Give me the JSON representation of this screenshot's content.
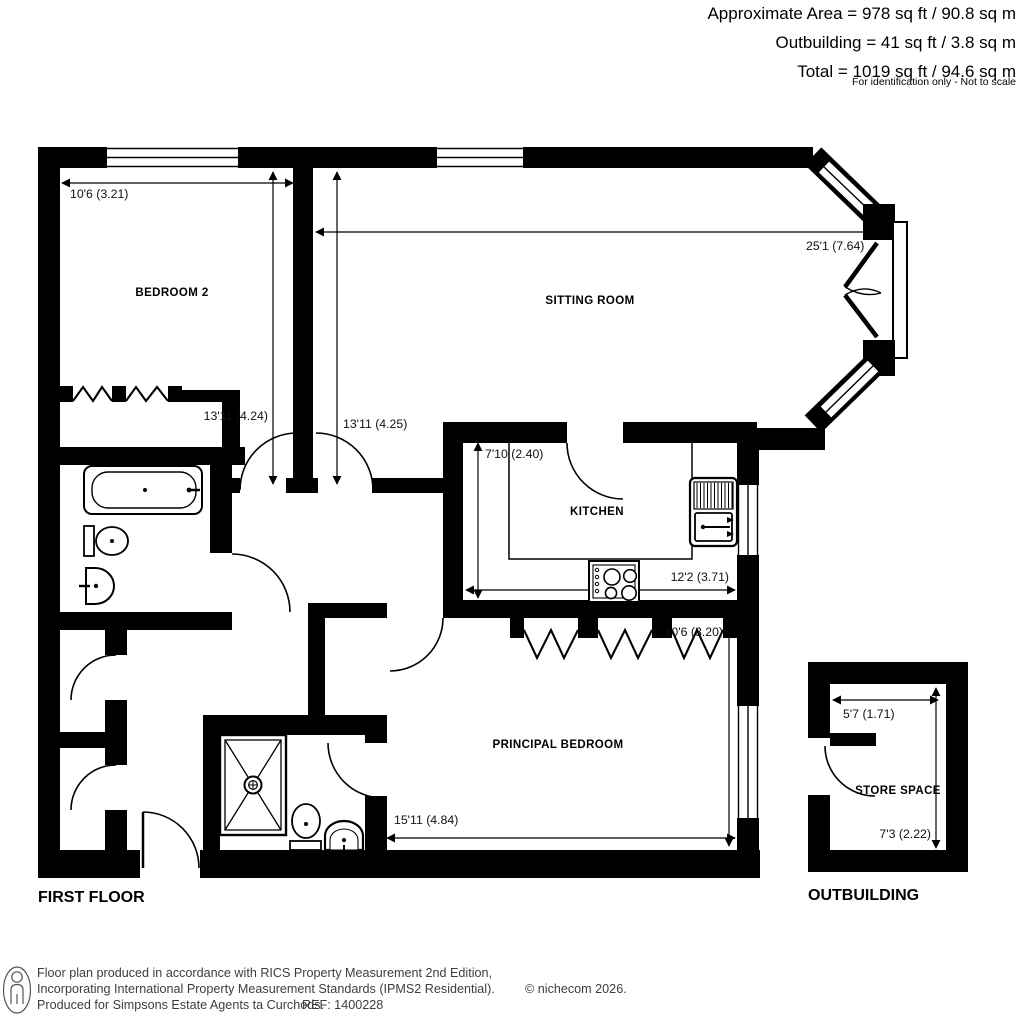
{
  "header": {
    "approximate_area": "Approximate Area = 978 sq ft / 90.8 sq m",
    "outbuilding_area": "Outbuilding = 41 sq ft / 3.8 sq m",
    "total_area": "Total = 1019 sq ft / 94.6 sq m",
    "note": "For identification only - Not to scale"
  },
  "plan": {
    "first_floor_label": "FIRST FLOOR",
    "outbuilding_label": "OUTBUILDING"
  },
  "rooms": [
    {
      "name": "BEDROOM 2",
      "width_label": "10'6 (3.21)",
      "depth_label": "13'11 (4.24)"
    },
    {
      "name": "SITTING ROOM",
      "width_label": "25'1 (7.64)",
      "depth_label": "13'11 (4.25)"
    },
    {
      "name": "KITCHEN",
      "width_label": "12'2 (3.71)",
      "depth_label": "7'10 (2.40)"
    },
    {
      "name": "PRINCIPAL BEDROOM",
      "width_label": "15'11 (4.84)",
      "depth_label": "10'6 (3.20)"
    },
    {
      "name": "STORE SPACE",
      "width_label": "5'7 (1.71)",
      "depth_label": "7'3 (2.22)"
    }
  ],
  "footer": {
    "line1": "Floor plan produced in accordance with RICS Property Measurement 2nd Edition,",
    "line2": "Incorporating International Property Measurement Standards (IPMS2 Residential).",
    "copyright": "© nichecom 2026.",
    "line3": "Produced for Simpsons Estate Agents ta Curchods.",
    "ref": "REF: 1400228"
  },
  "colors": {
    "wall": "#000000",
    "background": "#ffffff",
    "dimension_text": "#111111",
    "footer_text": "#3d3d3d"
  }
}
